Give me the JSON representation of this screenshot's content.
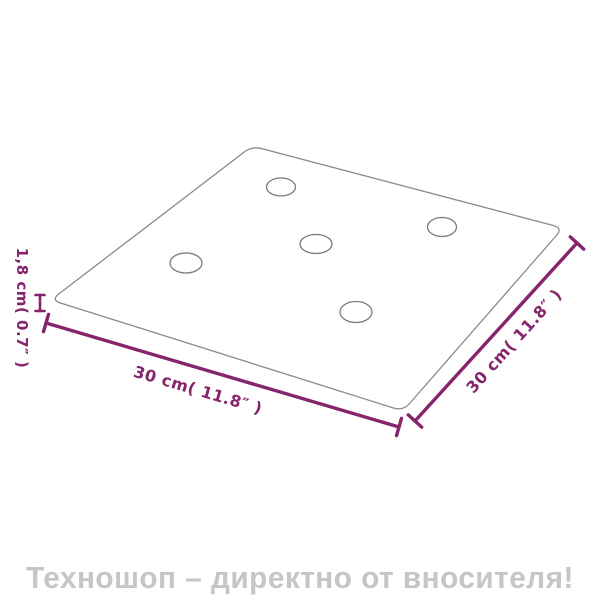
{
  "diagram": {
    "type": "product-dimension-diagram",
    "panel": {
      "shape": "square panel in perspective with rounded corners",
      "holes": 5
    },
    "labels": {
      "width": "30 cm( 11.8″ )",
      "depth": "30 cm( 11.8″ )",
      "thickness": "1,8 cm( 0.7″ )"
    },
    "colors": {
      "dimension": "#86246c",
      "outline": "#8a8a8a",
      "watermark": "#c6c6c6",
      "background": "#ffffff"
    }
  },
  "footer": {
    "watermark": "Техношоп – директно от вносителя!"
  }
}
